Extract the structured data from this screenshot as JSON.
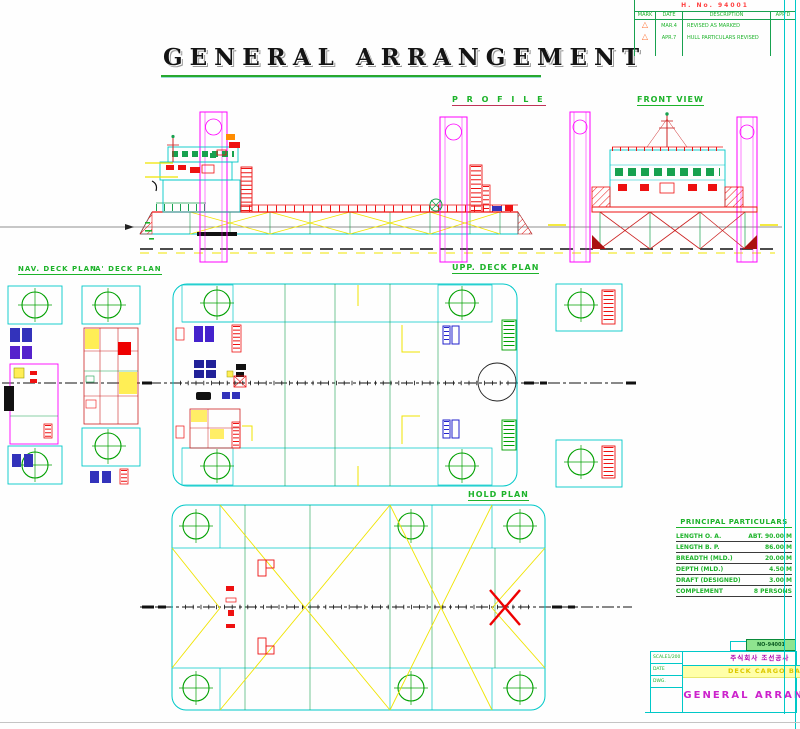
{
  "colors": {
    "cyan_lines": "#00c8c8",
    "magenta_lines": "#ff00ff",
    "red_details": "#ee1111",
    "green_text": "#1db32a",
    "yellow_bracing": "#f0e400",
    "blue_fittings": "#3333bb",
    "title_black": "#141414",
    "title_block_magenta": "#cc22cc",
    "subtitle_yellow": "#dcc800"
  },
  "header": {
    "title": "GENERAL  ARRANGEMENT"
  },
  "revision_block": {
    "doc_no": "H. No. 94001",
    "headers": [
      "MARK",
      "DATE",
      "DESCRIPTION",
      "APP'D"
    ],
    "rows": [
      {
        "mark": "1",
        "date": "MAR.4",
        "desc": "REVISED AS MARKED",
        "appd": ""
      },
      {
        "mark": "2",
        "date": "APR.7",
        "desc": "HULL PARTICULARS REVISED",
        "appd": ""
      }
    ]
  },
  "view_labels": {
    "profile": "P R O F I L E",
    "front": "FRONT VIEW",
    "nav_deck": "NAV. DECK PLAN",
    "a_deck": "'A' DECK PLAN",
    "upper_deck": "UPP. DECK PLAN",
    "hold": "HOLD PLAN"
  },
  "particulars": {
    "title": "PRINCIPAL PARTICULARS",
    "rows": [
      {
        "name": "LENGTH  O. A.",
        "value": "ABT. 90.00 M"
      },
      {
        "name": "LENGTH  B. P.",
        "value": "86.00 M"
      },
      {
        "name": "BREADTH  (MLD.)",
        "value": "20.00 M"
      },
      {
        "name": "DEPTH  (MLD.)",
        "value": "4.50 M"
      },
      {
        "name": "DRAFT  (DESIGNED)",
        "value": "3.00 M"
      },
      {
        "name": "COMPLEMENT",
        "value": "8 PERSONS"
      }
    ]
  },
  "title_block": {
    "doc_box": "NO-94001",
    "company": "주식회사 조선공사",
    "sheet_no": "No. 1",
    "rev_no": "Rev. 0",
    "subtitle": "DECK CARGO BARGE",
    "drawing_title": "GENERAL ARRANGEMENT",
    "info": [
      {
        "label": "SCALE",
        "value": "1/200"
      },
      {
        "label": "DATE",
        "value": ""
      },
      {
        "label": "DWG.",
        "value": ""
      },
      {
        "label": "",
        "value": ""
      }
    ]
  }
}
